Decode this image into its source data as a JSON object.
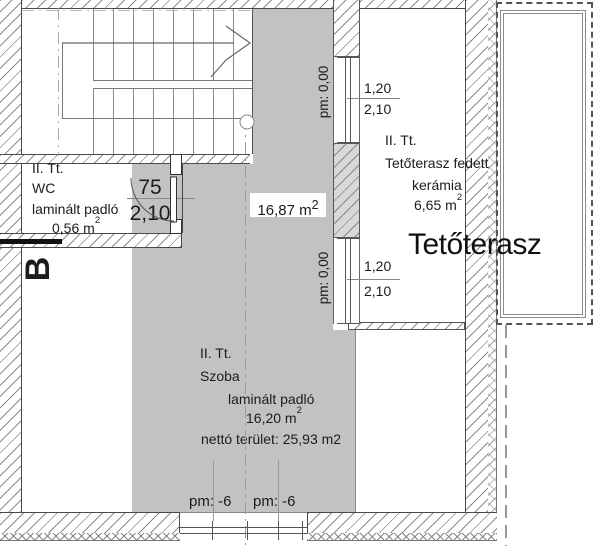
{
  "plan": {
    "section_label": "B",
    "wc": {
      "level": "II. Tt.",
      "name": "WC",
      "floor": "laminált padló",
      "area": "0,56 m",
      "area_sup": "2"
    },
    "door": {
      "width": "75",
      "height": "2,10"
    },
    "hall": {
      "area": "16,87 m",
      "area_sup": "2"
    },
    "pm_zero_top": "pm: 0,00",
    "pm_zero_bottom": "pm: 0,00",
    "window_top": {
      "width": "1,20",
      "height": "2,10"
    },
    "window_bottom": {
      "width": "1,20",
      "height": "2,10"
    },
    "covered_terrace": {
      "level": "II. Tt.",
      "name": "Tetőterasz fedett",
      "floor": "kerámia",
      "area": "6,65 m",
      "area_sup": "2"
    },
    "terrace_title": "Tetőterasz",
    "room": {
      "level": "II. Tt.",
      "name": "Szoba",
      "floor": "laminált padló",
      "area": "16,20 m",
      "area_sup": "2",
      "net": "nettó terület: 25,93 m2"
    },
    "pm_minus_left": "pm: -6",
    "pm_minus_right": "pm: -6",
    "colors": {
      "floor_gray": "#c2c2c2",
      "wall_outline": "#4a4a4a",
      "hatch_line": "#8a8a8a",
      "text": "#1c1c1c"
    }
  }
}
